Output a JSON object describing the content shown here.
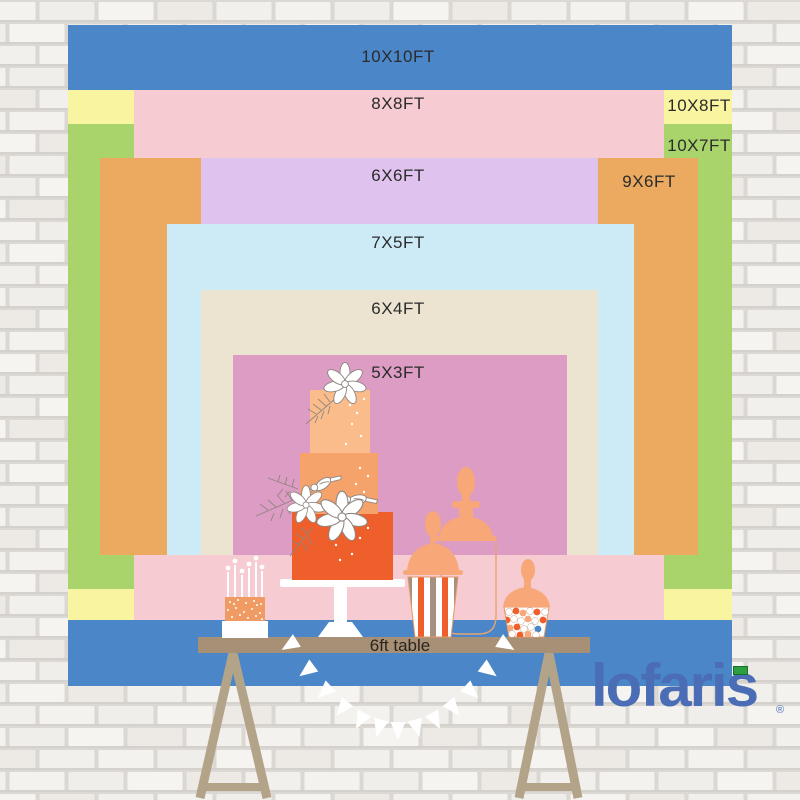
{
  "page": {
    "description": "Backdrop size comparison chart hanging on a white brick wall with a dessert table in front"
  },
  "backdrop": {
    "label_color": "#2b2b2b",
    "rects": [
      {
        "id": "10x10",
        "label": "10X10FT",
        "color": "#4a86c8",
        "x": 68,
        "y": 25,
        "w": 664,
        "h": 661,
        "label_x": 398,
        "label_y": 57
      },
      {
        "id": "10x8",
        "label": "10X8FT",
        "color": "#f8f4a0",
        "x": 68,
        "y": 90,
        "w": 664,
        "h": 530,
        "label_x": 699,
        "label_y": 106
      },
      {
        "id": "10x7",
        "label": "10X7FT",
        "color": "#a9d46c",
        "x": 68,
        "y": 124,
        "w": 664,
        "h": 465,
        "label_x": 699,
        "label_y": 146
      },
      {
        "id": "8x8",
        "label": "8X8FT",
        "color": "#f6cbd1",
        "x": 134,
        "y": 90,
        "w": 530,
        "h": 530,
        "label_x": 398,
        "label_y": 104
      },
      {
        "id": "9x6",
        "label": "9X6FT",
        "color": "#ebaa5f",
        "x": 100,
        "y": 158,
        "w": 598,
        "h": 397,
        "label_x": 649,
        "label_y": 182
      },
      {
        "id": "6x6",
        "label": "6X6FT",
        "color": "#dfc3ee",
        "x": 201,
        "y": 158,
        "w": 397,
        "h": 397,
        "label_x": 398,
        "label_y": 176
      },
      {
        "id": "7x5",
        "label": "7X5FT",
        "color": "#cdebf7",
        "x": 167,
        "y": 224,
        "w": 467,
        "h": 331,
        "label_x": 398,
        "label_y": 243
      },
      {
        "id": "6x4",
        "label": "6X4FT",
        "color": "#ece3d1",
        "x": 201,
        "y": 290,
        "w": 397,
        "h": 265,
        "label_x": 398,
        "label_y": 309
      },
      {
        "id": "5x3",
        "label": "5X3FT",
        "color": "#dd9cc3",
        "x": 233,
        "y": 355,
        "w": 334,
        "h": 200,
        "label_x": 398,
        "label_y": 373
      }
    ]
  },
  "table": {
    "label": "6ft table",
    "surface_color": "#a89076",
    "leg_color": "#b3a389"
  },
  "logo": {
    "text": "lofaris",
    "reg_mark": "®",
    "color": "#4a6db5",
    "flag_color": "#2e9e42"
  },
  "illustration": {
    "cake_top": "#fabc8b",
    "cake_mid": "#f5a26b",
    "cake_bottom": "#ef5f2b",
    "peach": "#f8a778",
    "stripe_tan": "#a5917f",
    "stripe_orange": "#ef5f2b",
    "candy_blue": "#4a87c9",
    "line_color": "#8e8680"
  }
}
